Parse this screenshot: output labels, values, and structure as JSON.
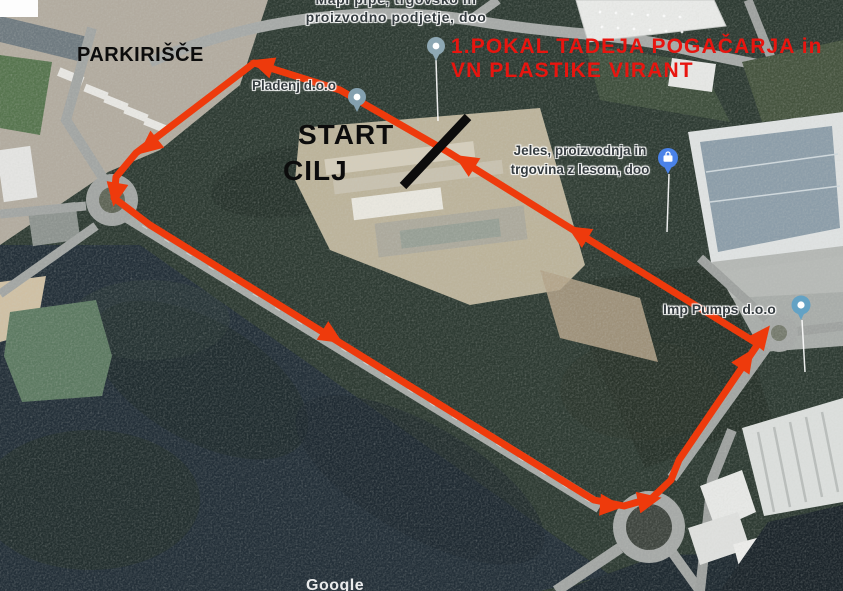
{
  "map": {
    "attribution": "Google",
    "labels": {
      "mapi_line1": "Mapi pipe, trgovsko in",
      "mapi_line2": "proizvodno podjetje, doo",
      "pladenj": "Pladenj d.o.o",
      "jeles_line1": "Jeles, proizvodnja in",
      "jeles_line2": "trgovina z lesom, doo",
      "imp": "Imp Pumps d.o.o"
    },
    "icons": {
      "pladenj_pin": "map-pin",
      "event_pin": "map-pin",
      "jeles_pin": "briefcase-map-pin",
      "imp_pin": "map-pin"
    }
  },
  "annotations": {
    "parking": "PARKIRIŠČE",
    "start": "START",
    "finish": "CILJ",
    "title_line1": "1.POKAL TADEJA POGAČARJA in",
    "title_line2": "VN PLASTIKE VIRANT"
  },
  "colors": {
    "route": "#ee3a0c",
    "title_red": "#e8150f",
    "start_line": "#0c0c0c",
    "annotation_black": "#0c0c0c",
    "map_label": "#343b3f"
  }
}
